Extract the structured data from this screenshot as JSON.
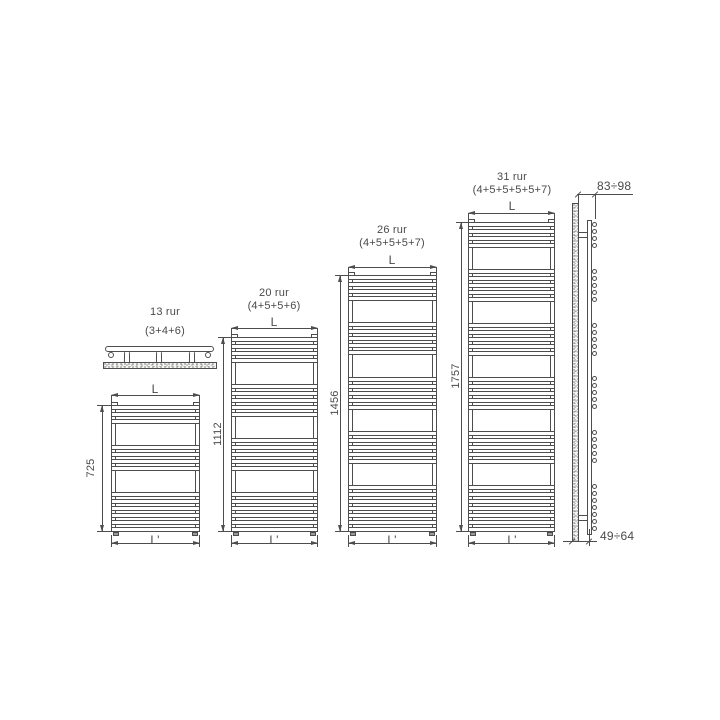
{
  "diagram": {
    "type": "technical-drawing",
    "subject": "towel radiator size variants: four front views with plan view and wall-mounted side view",
    "line_color": "#4d4d4d",
    "text_color": "#4a4a4a",
    "width_label": "L",
    "bottom_width_label": "L'",
    "radiators": [
      {
        "name": "13 rur",
        "formula": "(3+4+6)",
        "tube_groups": [
          3,
          4,
          6
        ],
        "total_tubes": 13,
        "height_label": "725"
      },
      {
        "name": "20 rur",
        "formula": "(4+5+5+6)",
        "tube_groups": [
          4,
          5,
          5,
          6
        ],
        "total_tubes": 20,
        "height_label": "1112"
      },
      {
        "name": "26 rur",
        "formula": "(4+5+5+5+7)",
        "tube_groups": [
          4,
          5,
          5,
          5,
          7
        ],
        "total_tubes": 26,
        "height_label": "1456"
      },
      {
        "name": "31 rur",
        "formula": "(4+5+5+5+5+7)",
        "tube_groups": [
          4,
          5,
          5,
          5,
          5,
          7
        ],
        "total_tubes": 31,
        "height_label": "1757"
      }
    ],
    "side_view": {
      "depth_top_label": "83÷98",
      "depth_bottom_label": "49÷64",
      "tube_groups": [
        4,
        5,
        5,
        5,
        5,
        7
      ]
    }
  }
}
